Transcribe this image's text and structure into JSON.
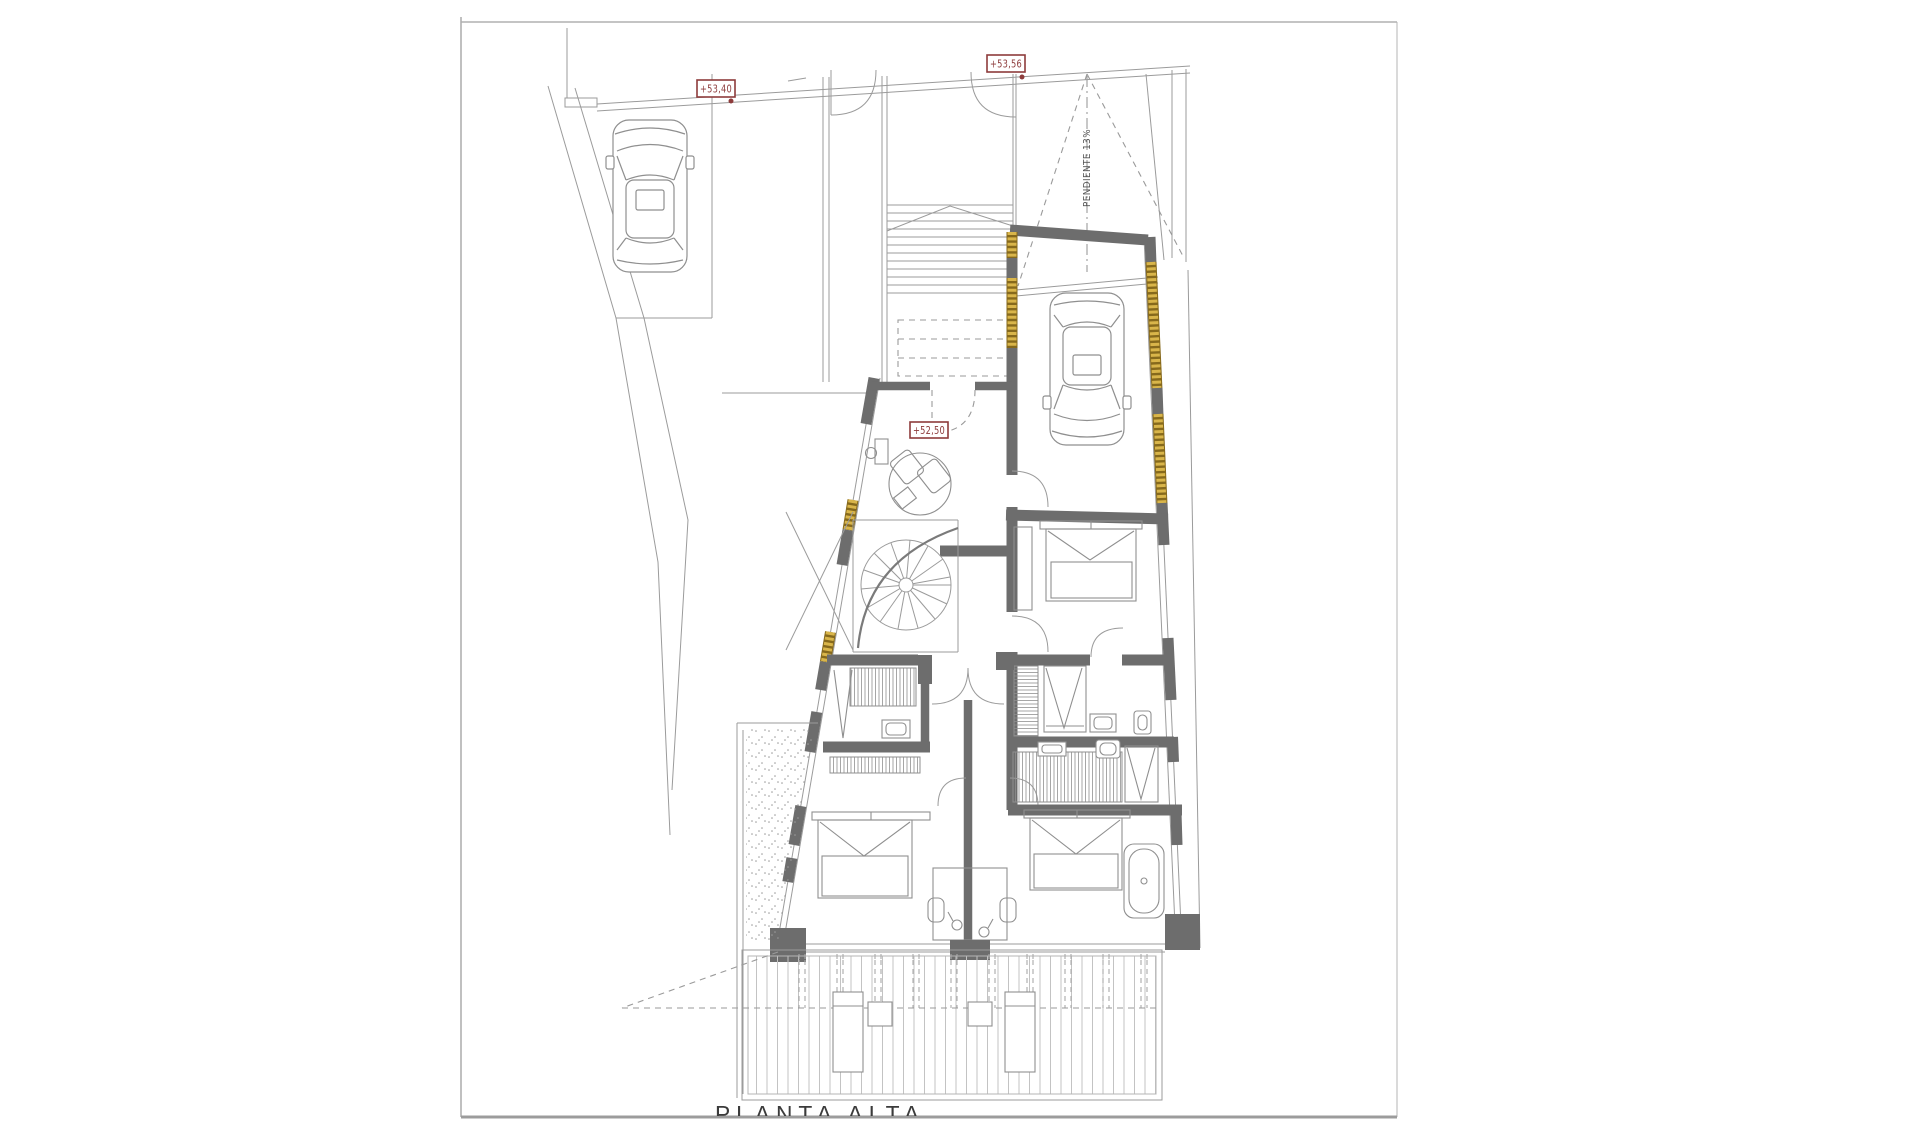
{
  "sheet": {
    "title": "PLANTA ALTA"
  },
  "labels": {
    "elev_top_left": "+53,40",
    "elev_top_right": "+53,56",
    "elev_hall": "+52,50",
    "ramp_note": "PENDIENTE 13%"
  },
  "colors": {
    "label_red": "#8d3b3b",
    "wall_gray": "#6d6d6d",
    "line_gray": "#9b9b9b",
    "window_gold": "#d9b54a",
    "title_color": "#3b3b3b",
    "sheet_border": "#b0b0b0",
    "background": "#ffffff"
  },
  "depicts": "architectural upper-floor plan: parking with car, straight stair, car ramp, garage with car, entry hall, spiral staircase, three bedrooms, two bathrooms, wardrobes, bathtub, double desk, terrace with decking and sun loungers"
}
